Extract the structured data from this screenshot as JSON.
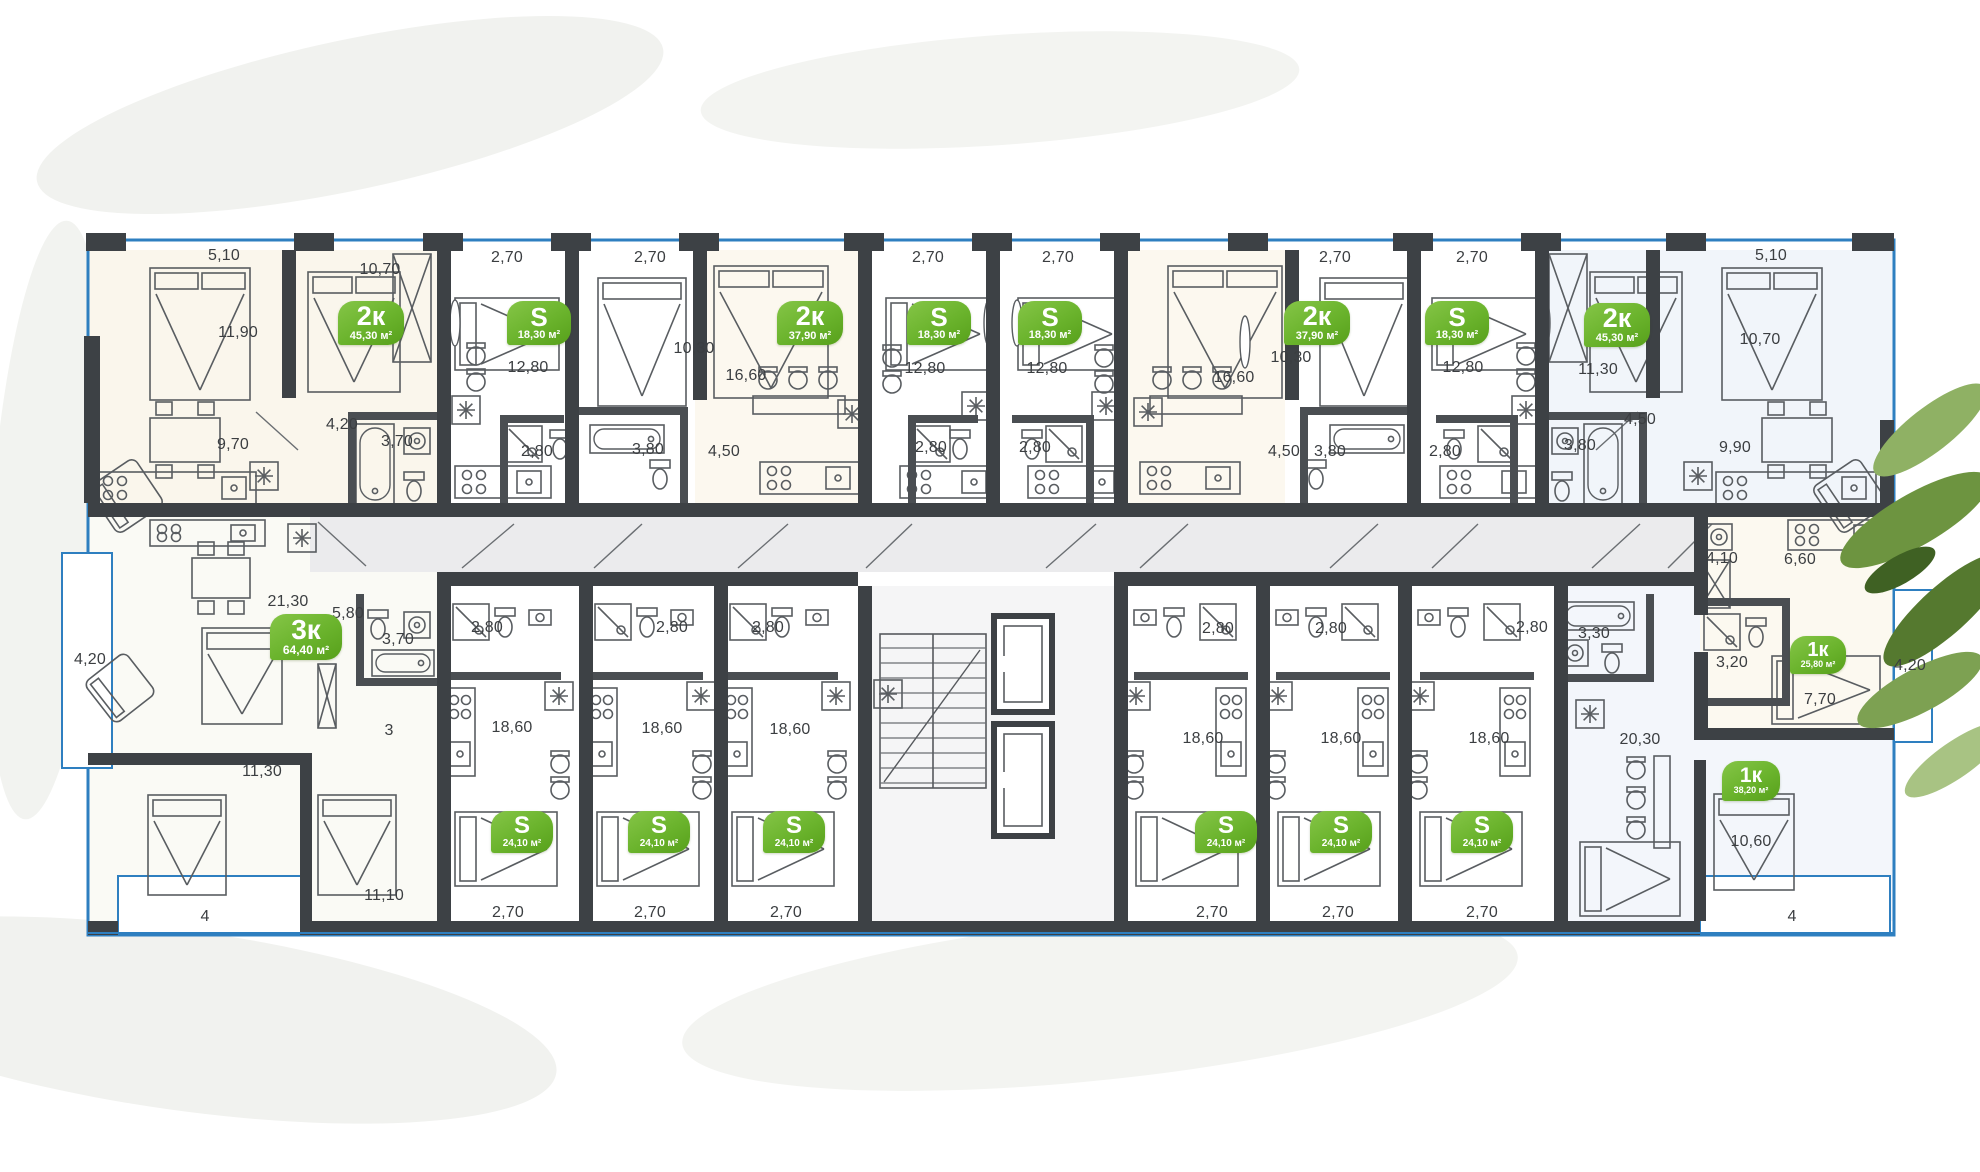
{
  "plan": {
    "area_unit": "м²",
    "colors": {
      "badge_green": "#6ab32c",
      "wall_dark": "#3d4145",
      "glazing_blue": "#2e7fc0",
      "corridor_gray": "#ebebed",
      "label_text": "#3b3e41",
      "leaf_green": "#6d9440"
    },
    "badges": [
      {
        "type": "2к",
        "area": "45,30 м²",
        "x": 371,
        "y": 323,
        "w": 66,
        "h": 44,
        "fs": 27
      },
      {
        "type": "S",
        "area": "18,30 м²",
        "x": 539,
        "y": 323,
        "w": 64,
        "h": 44,
        "fs": 26
      },
      {
        "type": "2к",
        "area": "37,90 м²",
        "x": 810,
        "y": 323,
        "w": 66,
        "h": 44,
        "fs": 27
      },
      {
        "type": "S",
        "area": "18,30 м²",
        "x": 939,
        "y": 323,
        "w": 64,
        "h": 44,
        "fs": 26
      },
      {
        "type": "S",
        "area": "18,30 м²",
        "x": 1050,
        "y": 323,
        "w": 64,
        "h": 44,
        "fs": 26
      },
      {
        "type": "2к",
        "area": "37,90 м²",
        "x": 1317,
        "y": 323,
        "w": 66,
        "h": 44,
        "fs": 27
      },
      {
        "type": "S",
        "area": "18,30 м²",
        "x": 1457,
        "y": 323,
        "w": 64,
        "h": 44,
        "fs": 26
      },
      {
        "type": "2к",
        "area": "45,30 м²",
        "x": 1617,
        "y": 325,
        "w": 66,
        "h": 44,
        "fs": 27
      },
      {
        "type": "3к",
        "area": "64,40 м²",
        "x": 306,
        "y": 637,
        "w": 72,
        "h": 46,
        "fs": 28
      },
      {
        "type": "S",
        "area": "24,10 м²",
        "x": 522,
        "y": 832,
        "w": 62,
        "h": 42,
        "fs": 24
      },
      {
        "type": "S",
        "area": "24,10 м²",
        "x": 659,
        "y": 832,
        "w": 62,
        "h": 42,
        "fs": 24
      },
      {
        "type": "S",
        "area": "24,10 м²",
        "x": 794,
        "y": 832,
        "w": 62,
        "h": 42,
        "fs": 24
      },
      {
        "type": "S",
        "area": "24,10 м²",
        "x": 1226,
        "y": 832,
        "w": 62,
        "h": 42,
        "fs": 24
      },
      {
        "type": "S",
        "area": "24,10 м²",
        "x": 1341,
        "y": 832,
        "w": 62,
        "h": 42,
        "fs": 24
      },
      {
        "type": "S",
        "area": "24,10 м²",
        "x": 1482,
        "y": 832,
        "w": 62,
        "h": 42,
        "fs": 24
      },
      {
        "type": "1к",
        "area": "25,80 м²",
        "x": 1818,
        "y": 655,
        "w": 56,
        "h": 38,
        "fs": 20
      },
      {
        "type": "1к",
        "area": "38,20 м²",
        "x": 1751,
        "y": 781,
        "w": 58,
        "h": 40,
        "fs": 21
      }
    ],
    "dimensions": [
      {
        "text": "5,10",
        "x": 224,
        "y": 256
      },
      {
        "text": "10,70",
        "x": 380,
        "y": 270
      },
      {
        "text": "2,70",
        "x": 507,
        "y": 258
      },
      {
        "text": "2,70",
        "x": 650,
        "y": 258
      },
      {
        "text": "2,70",
        "x": 928,
        "y": 258
      },
      {
        "text": "2,70",
        "x": 1058,
        "y": 258
      },
      {
        "text": "2,70",
        "x": 1335,
        "y": 258
      },
      {
        "text": "2,70",
        "x": 1472,
        "y": 258
      },
      {
        "text": "5,10",
        "x": 1771,
        "y": 256
      },
      {
        "text": "10,70",
        "x": 1760,
        "y": 340
      },
      {
        "text": "11,90",
        "x": 238,
        "y": 333
      },
      {
        "text": "12,80",
        "x": 528,
        "y": 368
      },
      {
        "text": "10,30",
        "x": 694,
        "y": 349
      },
      {
        "text": "16,60",
        "x": 746,
        "y": 376
      },
      {
        "text": "12,80",
        "x": 925,
        "y": 369
      },
      {
        "text": "12,80",
        "x": 1047,
        "y": 369
      },
      {
        "text": "16,60",
        "x": 1234,
        "y": 378
      },
      {
        "text": "10,30",
        "x": 1291,
        "y": 358
      },
      {
        "text": "12,80",
        "x": 1463,
        "y": 368
      },
      {
        "text": "11,30",
        "x": 1598,
        "y": 370
      },
      {
        "text": "9,70",
        "x": 233,
        "y": 445
      },
      {
        "text": "4,20",
        "x": 342,
        "y": 425
      },
      {
        "text": "3,70",
        "x": 397,
        "y": 442
      },
      {
        "text": "2,80",
        "x": 537,
        "y": 452
      },
      {
        "text": "3,80",
        "x": 648,
        "y": 450
      },
      {
        "text": "4,50",
        "x": 724,
        "y": 452
      },
      {
        "text": "2,80",
        "x": 931,
        "y": 448
      },
      {
        "text": "2,80",
        "x": 1035,
        "y": 448
      },
      {
        "text": "4,50",
        "x": 1284,
        "y": 452
      },
      {
        "text": "3,80",
        "x": 1330,
        "y": 452
      },
      {
        "text": "2,80",
        "x": 1445,
        "y": 452
      },
      {
        "text": "3,80",
        "x": 1580,
        "y": 446
      },
      {
        "text": "4,50",
        "x": 1640,
        "y": 420
      },
      {
        "text": "9,90",
        "x": 1735,
        "y": 448
      },
      {
        "text": "4,10",
        "x": 1722,
        "y": 559
      },
      {
        "text": "6,60",
        "x": 1800,
        "y": 560
      },
      {
        "text": "3,20",
        "x": 1732,
        "y": 663
      },
      {
        "text": "7,70",
        "x": 1820,
        "y": 700
      },
      {
        "text": "4,20",
        "x": 1910,
        "y": 666
      },
      {
        "text": "21,30",
        "x": 288,
        "y": 602
      },
      {
        "text": "5,80",
        "x": 348,
        "y": 614
      },
      {
        "text": "3,70",
        "x": 398,
        "y": 640
      },
      {
        "text": "4,20",
        "x": 90,
        "y": 660
      },
      {
        "text": "11,30",
        "x": 262,
        "y": 772
      },
      {
        "text": "3",
        "x": 389,
        "y": 731
      },
      {
        "text": "11,10",
        "x": 384,
        "y": 896
      },
      {
        "text": "4",
        "x": 205,
        "y": 917
      },
      {
        "text": "2,80",
        "x": 487,
        "y": 628
      },
      {
        "text": "18,60",
        "x": 512,
        "y": 728
      },
      {
        "text": "2,70",
        "x": 508,
        "y": 913
      },
      {
        "text": "2,80",
        "x": 672,
        "y": 628
      },
      {
        "text": "18,60",
        "x": 662,
        "y": 729
      },
      {
        "text": "2,70",
        "x": 650,
        "y": 913
      },
      {
        "text": "2,80",
        "x": 768,
        "y": 628
      },
      {
        "text": "18,60",
        "x": 790,
        "y": 730
      },
      {
        "text": "2,70",
        "x": 786,
        "y": 913
      },
      {
        "text": "2,80",
        "x": 1218,
        "y": 629
      },
      {
        "text": "18,60",
        "x": 1203,
        "y": 739
      },
      {
        "text": "2,70",
        "x": 1212,
        "y": 913
      },
      {
        "text": "2,80",
        "x": 1331,
        "y": 629
      },
      {
        "text": "18,60",
        "x": 1341,
        "y": 739
      },
      {
        "text": "2,70",
        "x": 1338,
        "y": 913
      },
      {
        "text": "2,80",
        "x": 1532,
        "y": 628
      },
      {
        "text": "18,60",
        "x": 1489,
        "y": 739
      },
      {
        "text": "2,70",
        "x": 1482,
        "y": 913
      },
      {
        "text": "3,30",
        "x": 1594,
        "y": 634
      },
      {
        "text": "20,30",
        "x": 1640,
        "y": 740
      },
      {
        "text": "10,60",
        "x": 1751,
        "y": 842
      },
      {
        "text": "4",
        "x": 1792,
        "y": 917
      }
    ]
  }
}
